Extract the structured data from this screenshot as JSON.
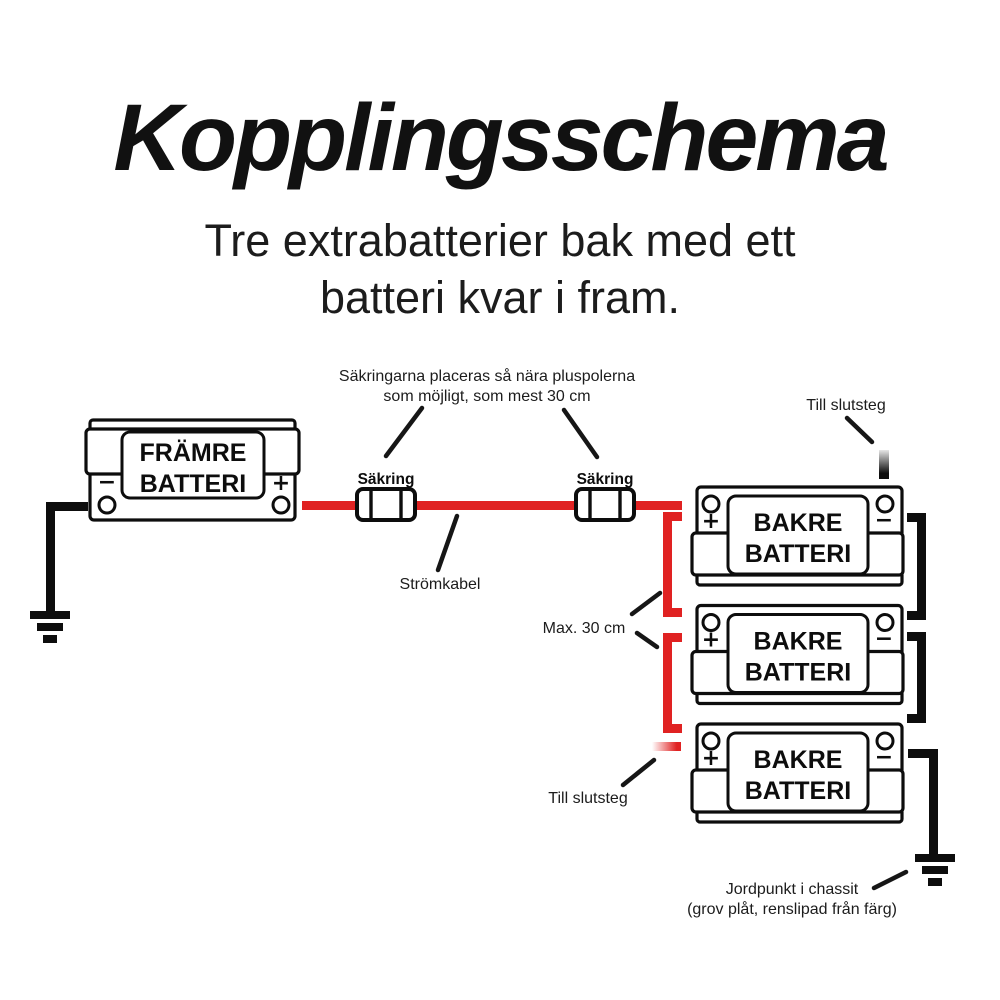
{
  "header": {
    "title": "Kopplingsschema",
    "subtitle_line1": "Tre extrabatterier bak med ett",
    "subtitle_line2": "batteri kvar i fram."
  },
  "front_battery": {
    "name_line1": "FRÄMRE",
    "name_line2": "BATTERI",
    "plus_sign": "+",
    "minus_sign": "−"
  },
  "rear_battery": {
    "name_line1": "BAKRE",
    "name_line2": "BATTERI",
    "plus_sign": "+",
    "minus_sign": "−"
  },
  "rear_battery_count": 3,
  "fuses": {
    "label": "Säkring",
    "count": 2
  },
  "annotations": {
    "fuse_note_line1": "Säkringarna placeras så nära pluspolerna",
    "fuse_note_line2": "som möjligt, som mest 30 cm",
    "till_slutsteg_top": "Till slutsteg",
    "stromkabel": "Strömkabel",
    "max_30_cm": "Max. 30 cm",
    "till_slutsteg_bottom": "Till slutsteg",
    "jordpunkt_line1": "Jordpunkt i chassit",
    "jordpunkt_line2": "(grov plåt, renslipad från färg)"
  },
  "colors": {
    "wire_red": "#e02222",
    "wire_black": "#0d0d0d",
    "background": "#ffffff",
    "text": "#161616"
  }
}
